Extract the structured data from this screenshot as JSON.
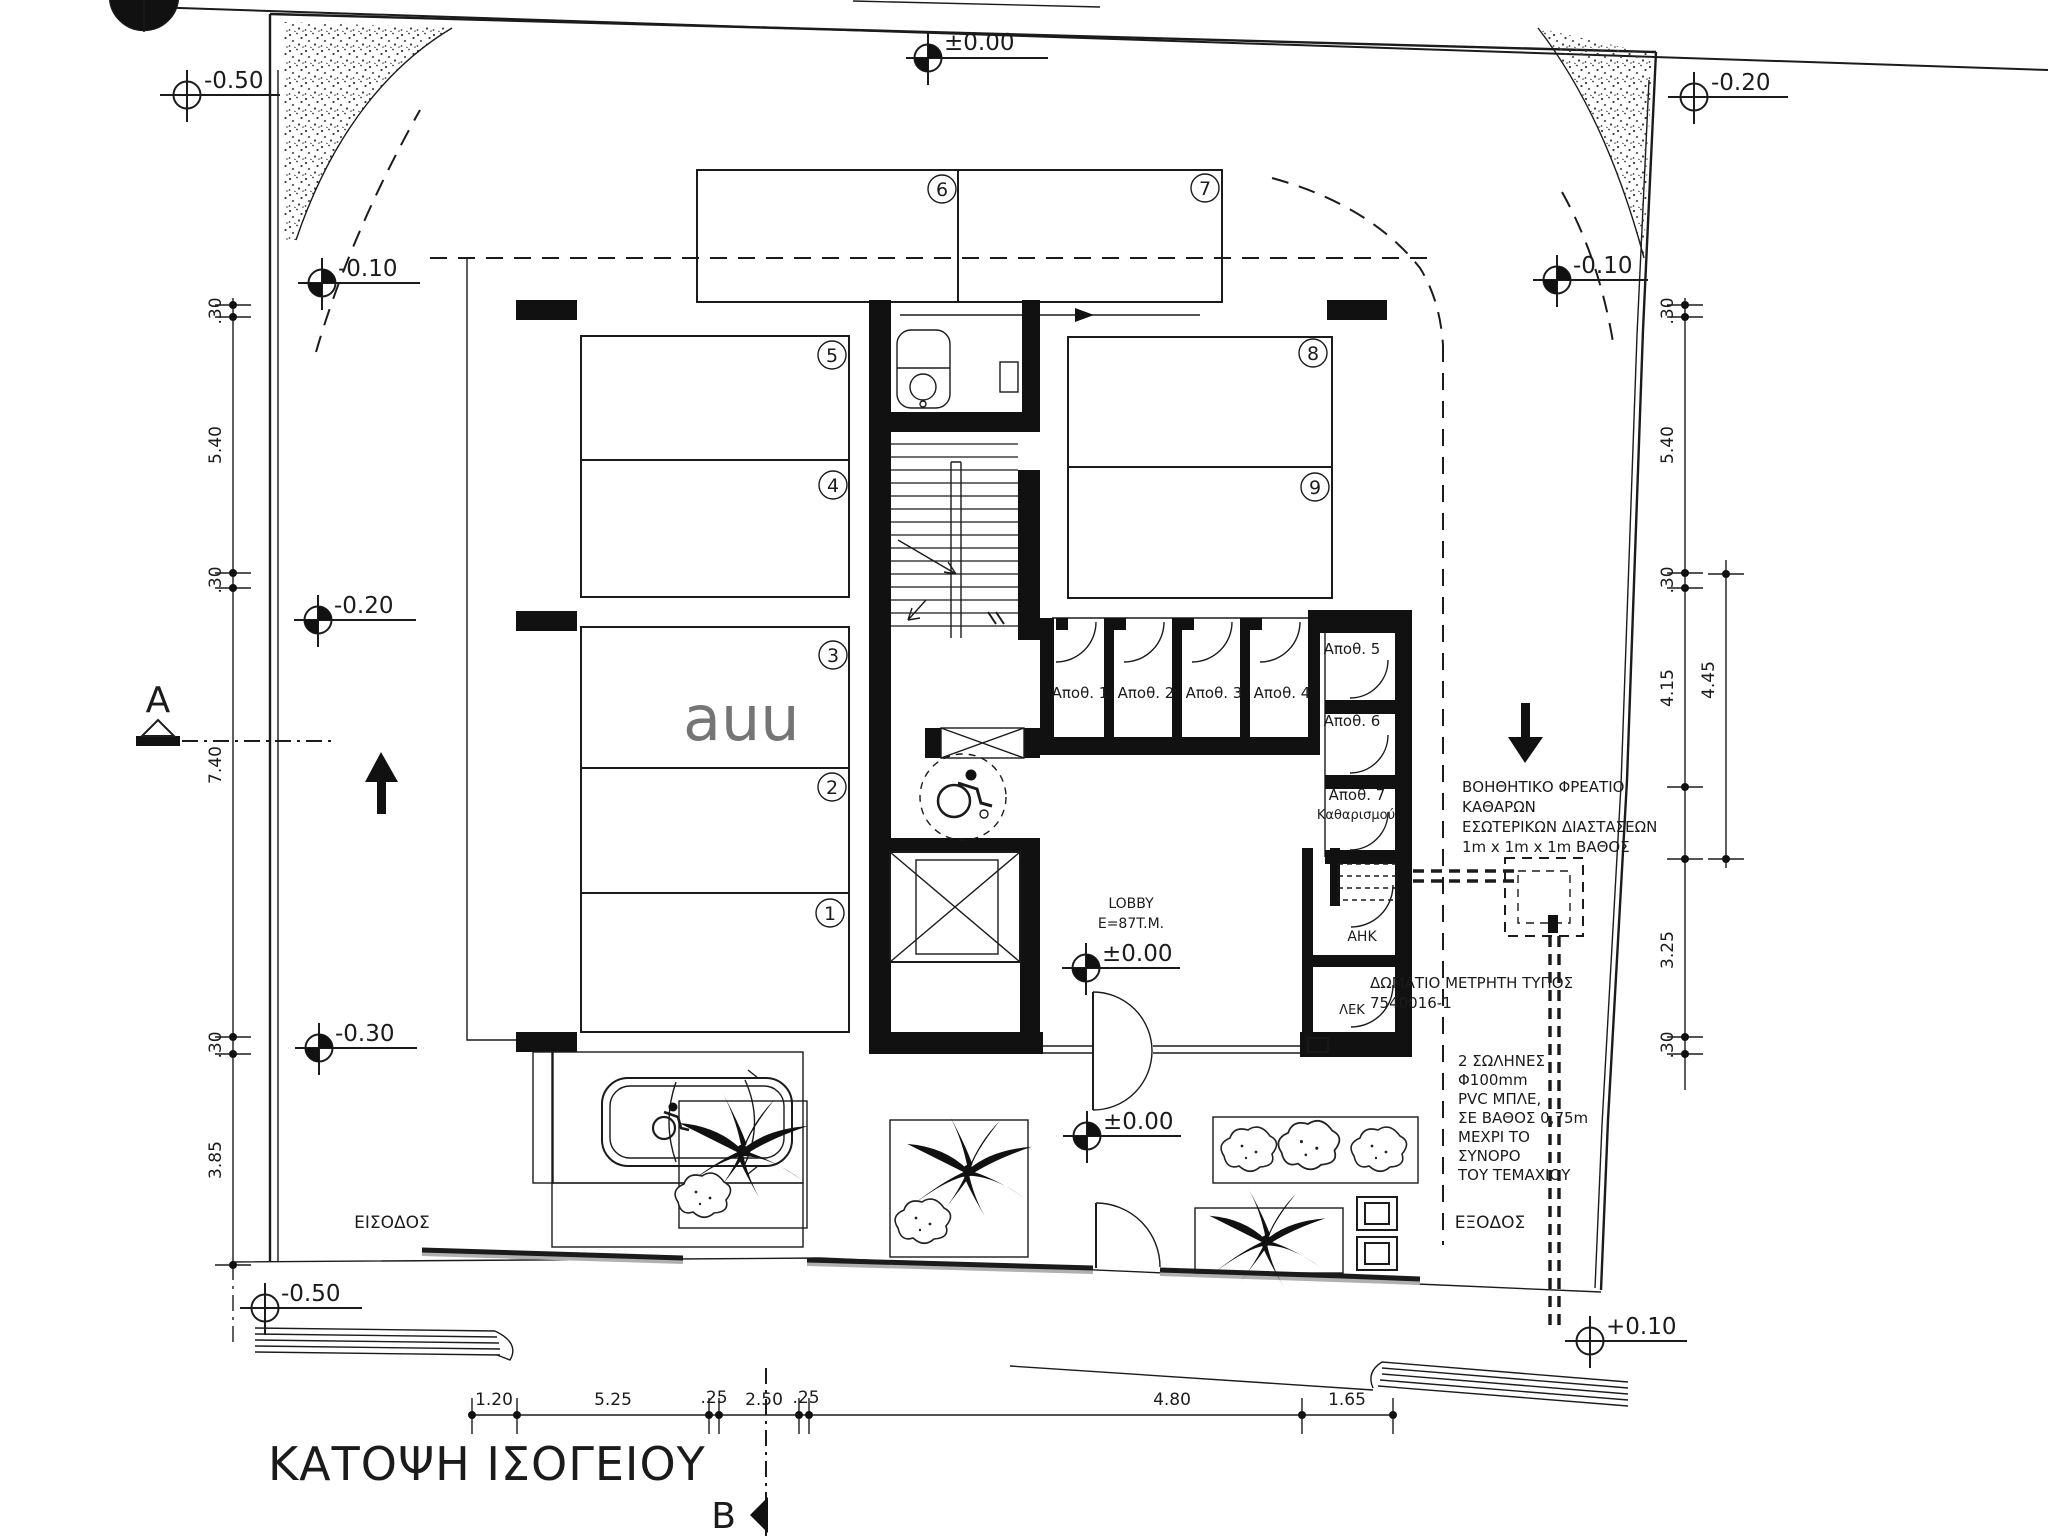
{
  "title": "ΚΑΤΟΨΗ ΙΣΟΓΕΙΟΥ",
  "sections": {
    "a": "A",
    "b": "B"
  },
  "levels": {
    "top": "±0.00",
    "top_left": "-0.50",
    "top_right": "-0.20",
    "left_upper": "-0.10",
    "right_upper": "-0.10",
    "left_mid": "-0.20",
    "left_lower": "-0.30",
    "bottom_left": "-0.50",
    "lobby": "±0.00",
    "entry": "±0.00",
    "bottom_right": "+0.10"
  },
  "parking_numbers": [
    "1",
    "2",
    "3",
    "4",
    "5",
    "6",
    "7",
    "8",
    "9"
  ],
  "storage_labels": {
    "s1": "Αποθ. 1",
    "s2": "Αποθ. 2",
    "s3": "Αποθ. 3",
    "s4": "Αποθ. 4",
    "s5": "Αποθ. 5",
    "s6": "Αποθ. 6",
    "s7": "Αποθ. 7",
    "s7b": "Καθαρισμού"
  },
  "rooms": {
    "lobby_name": "LOBBY",
    "lobby_area": "E=87T.M.",
    "ahk": "ΑΗΚ",
    "lek": "ΛΕΚ"
  },
  "annotations": {
    "pit_l1": "ΒΟΗΘΗΤΙΚΟ ΦΡΕΑΤΙΟ",
    "pit_l2": "ΚΑΘΑΡΩΝ",
    "pit_l3": "ΕΣΩΤΕΡΙΚΩΝ ΔΙΑΣΤΑΣΕΩΝ",
    "pit_l4": "1m x 1m x 1m ΒΑΘΟΣ",
    "meter_l1": "ΔΩΜΑΤΙΟ ΜΕΤΡΗΤΗ ΤΥΠΟΣ",
    "meter_l2": "7540016-1",
    "pipe_l1": "2 ΣΩΛΗΝΕΣ",
    "pipe_l2": "Φ100mm",
    "pipe_l3": "PVC ΜΠΛΕ,",
    "pipe_l4": "ΣΕ ΒΑΘΟΣ 0,75m",
    "pipe_l5": "ΜΕΧΡΙ ΤΟ",
    "pipe_l6": "ΣΥΝΟΡΟ",
    "pipe_l7": "ΤΟΥ ΤΕΜΑΧΙΟΥ",
    "entrance": "ΕΙΣΟΔΟΣ",
    "exit": "ΕΞΟΔΟΣ"
  },
  "dimensions": {
    "left": {
      "d1": ".30",
      "d2": "5.40",
      "d3": ".30",
      "d4": "7.40",
      "d5": ".30",
      "d6": "3.85"
    },
    "right": {
      "d1": ".30",
      "d2": "5.40",
      "d3": ".30",
      "d4": "4.15",
      "d5": "4.45",
      "d6": "3.25",
      "d7": ".30"
    },
    "bottom": {
      "d1": "1.20",
      "d2": "5.25",
      "d3": ".25",
      "d4": "2.50",
      "d5": ".25",
      "d6": "4.80",
      "d7": "1.65"
    }
  },
  "watermark": "auu",
  "colors": {
    "line": "#1b1b1b",
    "gray": "#b0b0b0"
  }
}
